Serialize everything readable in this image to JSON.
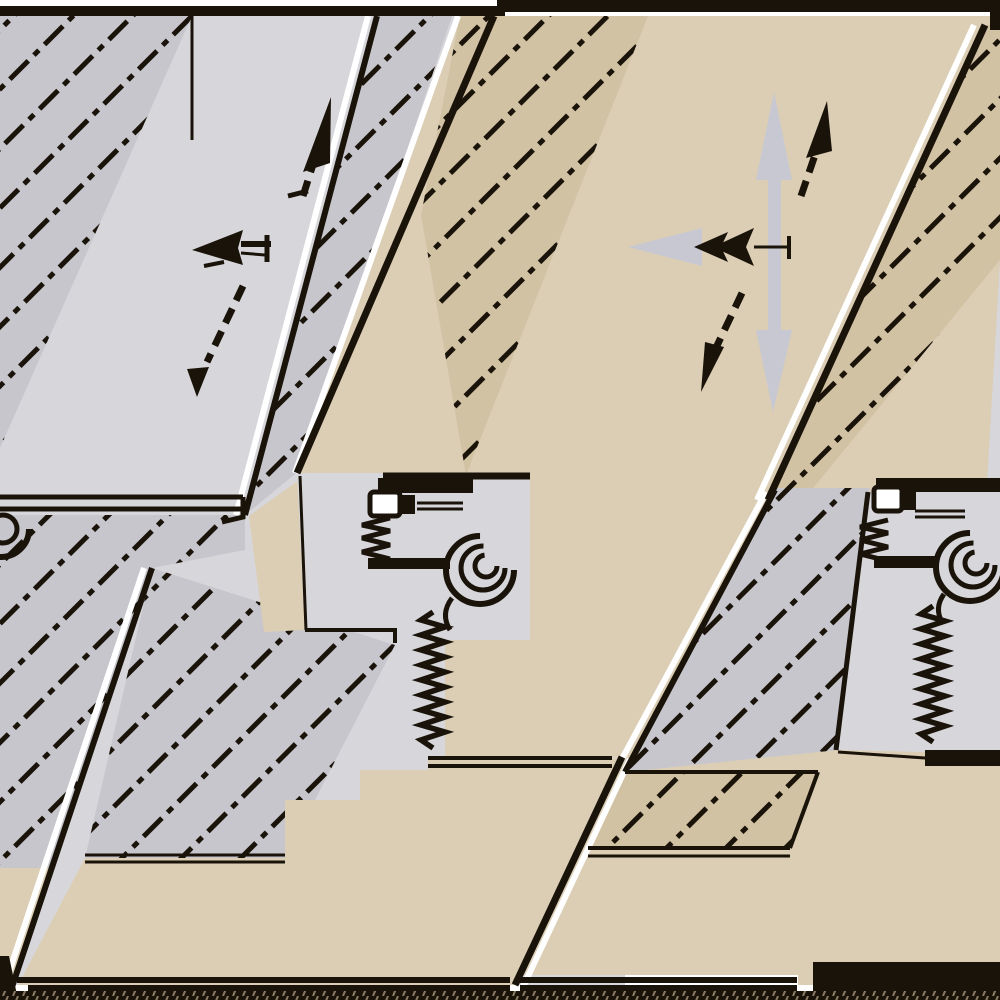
{
  "meta": {
    "kind": "technical-cross-section-diagram",
    "subject": "Sliding panel / furniture fitting cross-section shown in two adjacent views with section hatching, movement arrows, roller and spring mechanism",
    "views": [
      {
        "id": "left-view",
        "wall_material_color_role": "gray",
        "arrows": [
          "up",
          "left",
          "down"
        ],
        "arrow_style": "black dashed-shaft arrows"
      },
      {
        "id": "right-view",
        "wall_material_color_role": "tan",
        "arrows": [
          "up-down-double",
          "left",
          "up",
          "down"
        ],
        "arrow_style": "large gray arrows overlaid by black dashed-shaft arrows"
      }
    ],
    "parts": [
      "hatched-wall-section",
      "diagonal-panel-band",
      "mounting-bracket",
      "screw-head",
      "ribbed-clamp",
      "roller-spiral",
      "spring-zigzag",
      "base-plate",
      "ground-hatch-strip"
    ],
    "hatch_style": "45-degree chain lines (long dash - short dash)"
  },
  "colors": {
    "gray_plain": "#d7d7db",
    "gray_band": "#c6c6cc",
    "tan": "#dbceb5",
    "tan_band": "#d2c2a4",
    "line": "#1a130a",
    "white": "#ffffff",
    "arrow_gray": "#c7c8d2",
    "ground_tick": "#8a7a62"
  }
}
